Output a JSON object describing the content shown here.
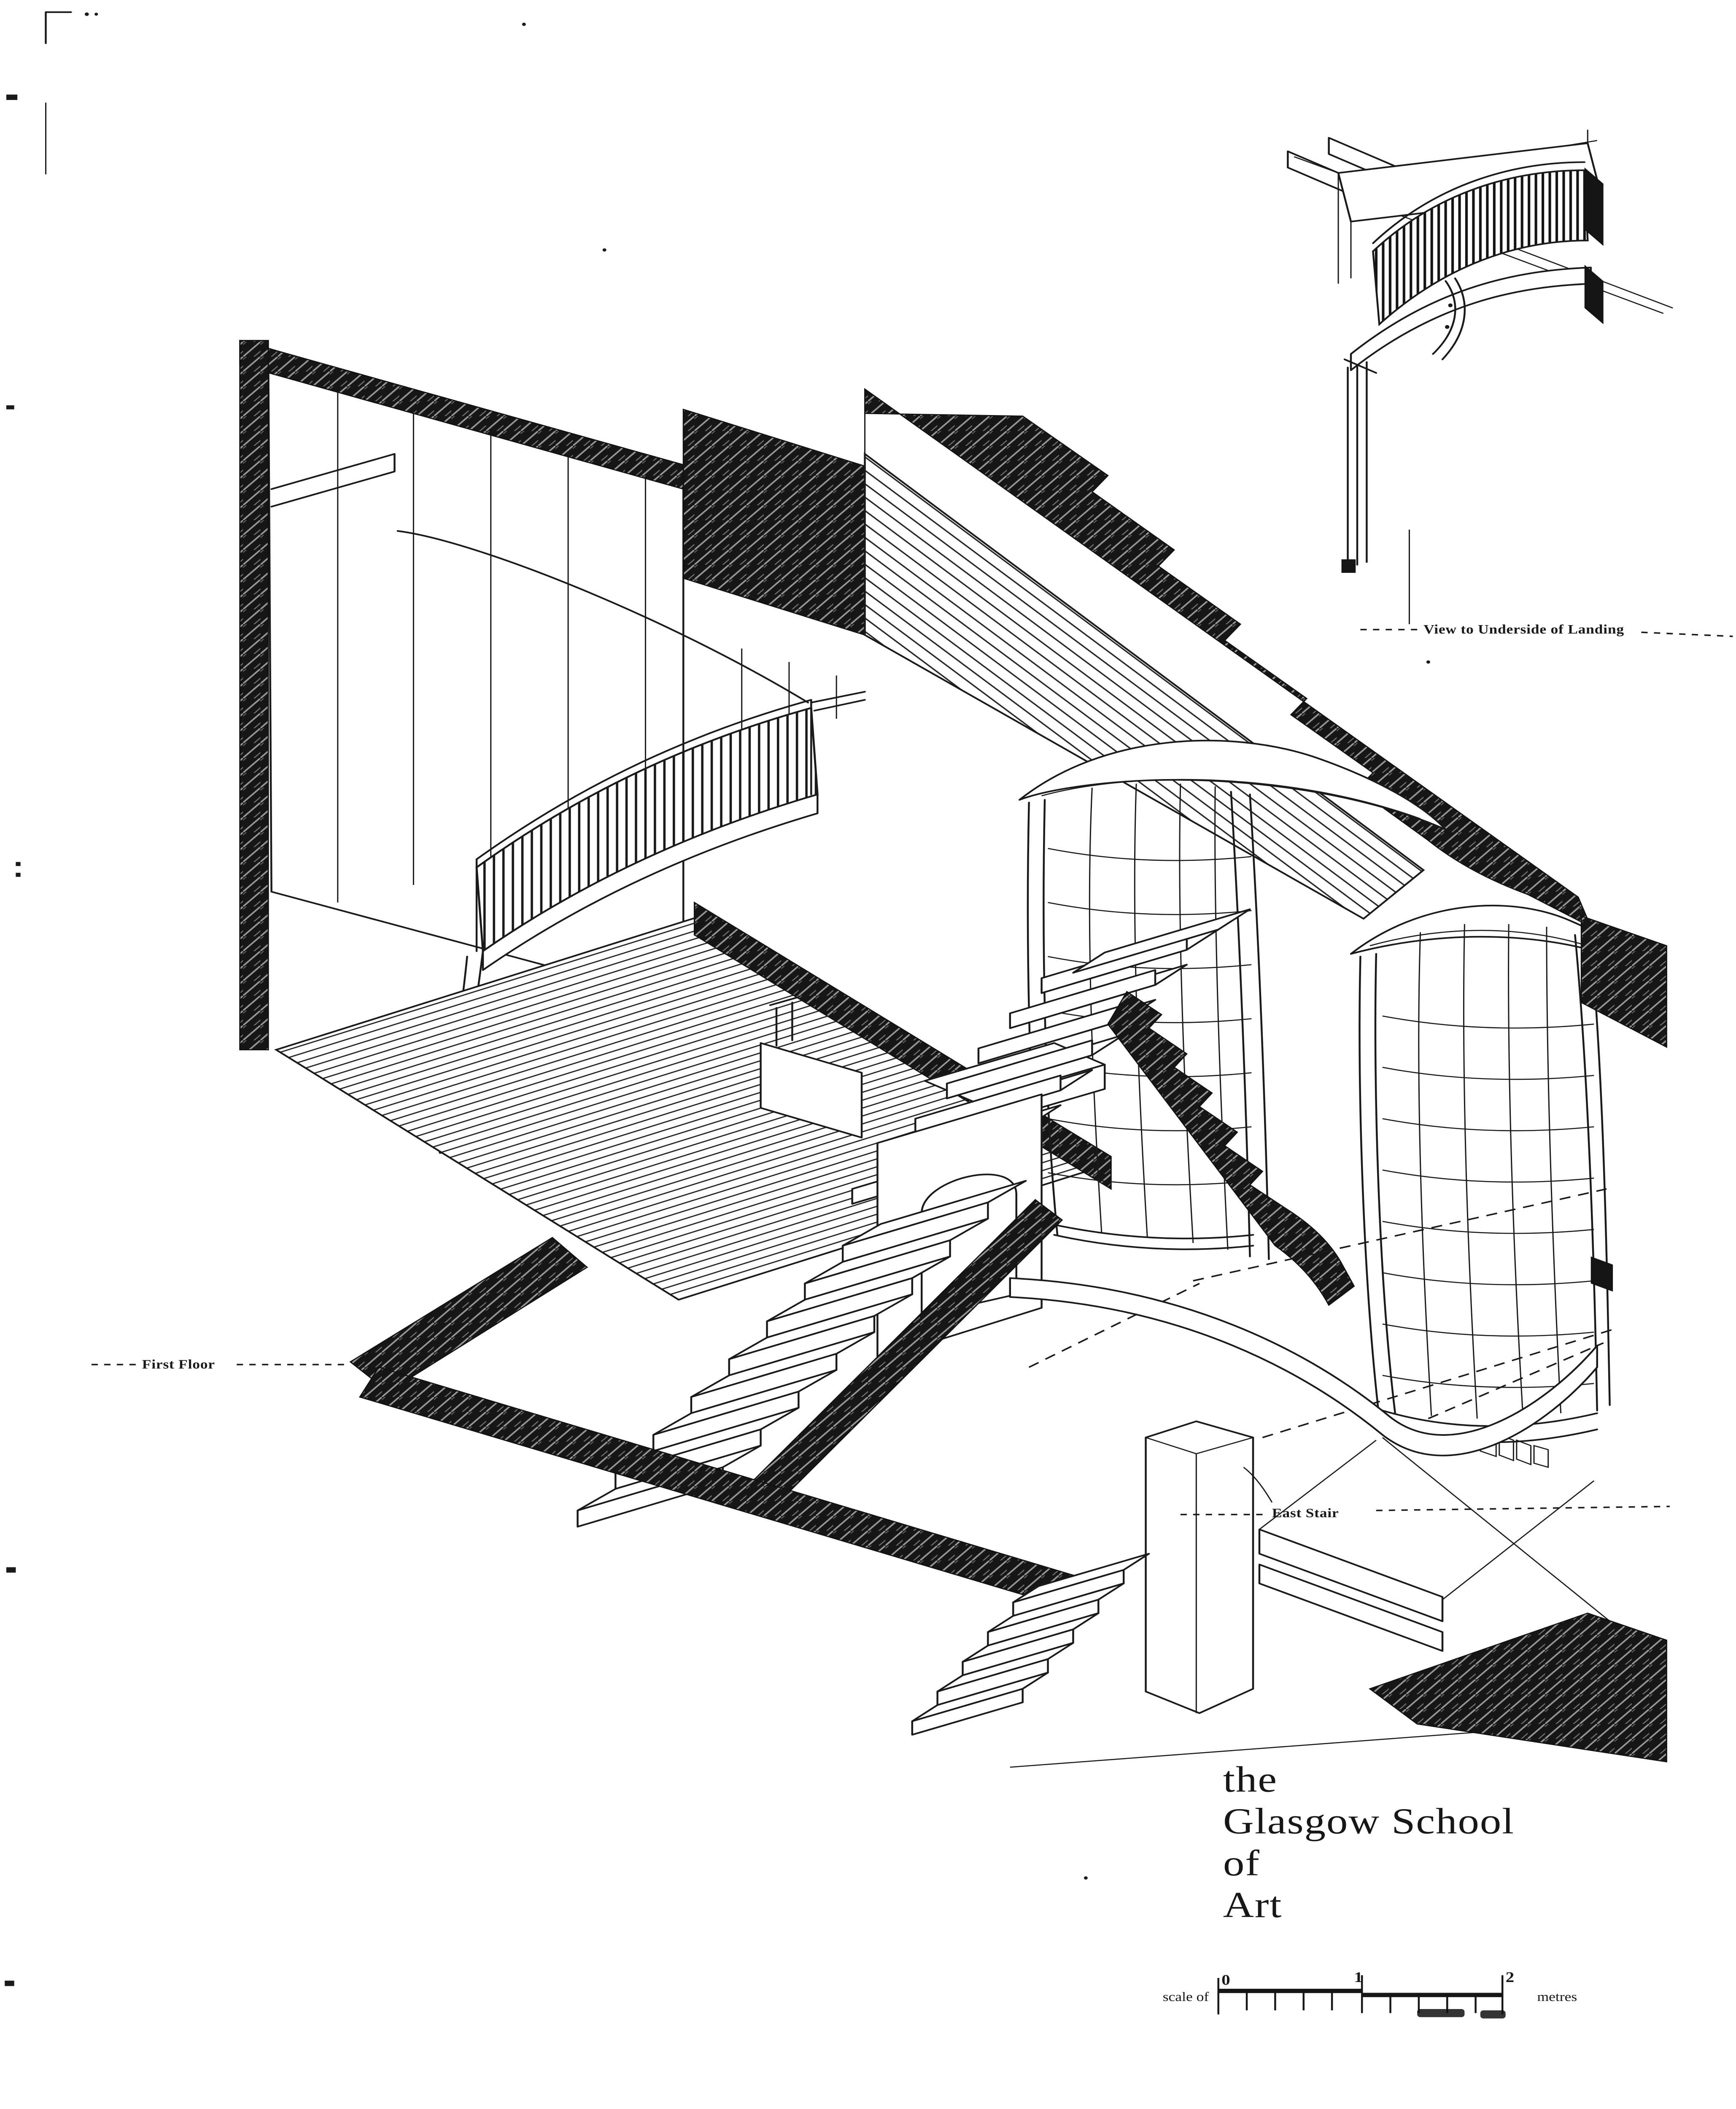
{
  "page": {
    "paper_color": "#ffffff",
    "ink_color": "#1a1a1a",
    "description_names": [
      "axonometric-cutaway-drawing",
      "detail-inset-drawing",
      "title-block",
      "scale-bar"
    ]
  },
  "labels": {
    "first_floor": "First Floor",
    "east_stair": "East Stair",
    "inset_caption": "View to Underside of Landing"
  },
  "title": {
    "line1": "the",
    "line2": "Glasgow School",
    "line3": "of",
    "line4": "Art"
  },
  "scale_bar": {
    "prefix": "scale of",
    "tick0": "0",
    "tick1": "1",
    "tick2": "2",
    "unit": "metres",
    "divisions": 10
  }
}
